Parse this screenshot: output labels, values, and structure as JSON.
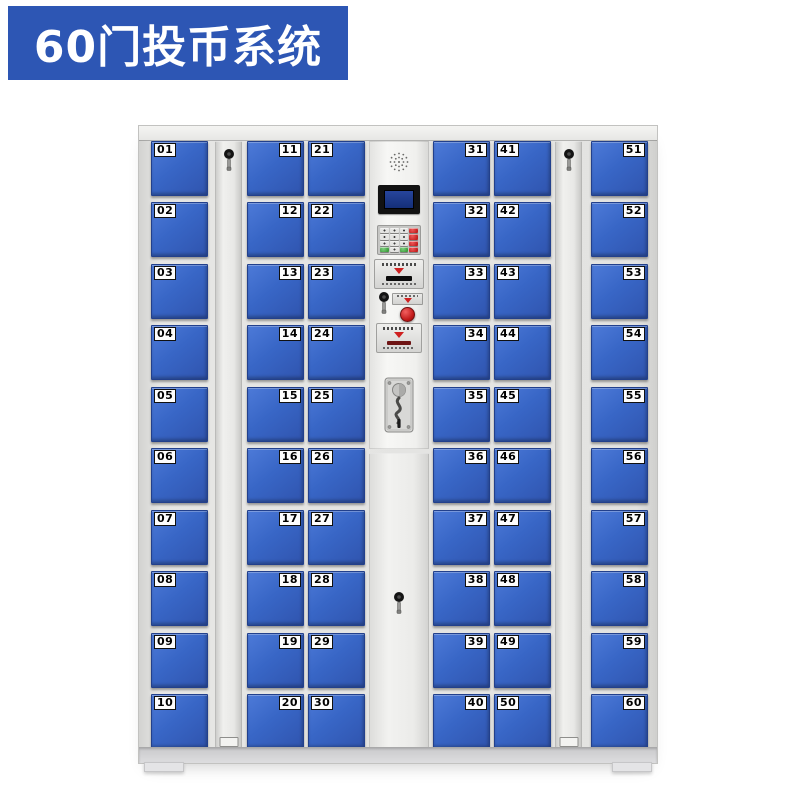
{
  "banner": {
    "title": "60门投币系统",
    "bg_color": "#2d56b4",
    "text_color": "#ffffff"
  },
  "cabinet": {
    "door_count": 60,
    "columns": [
      {
        "type": "doors",
        "label_side": "left",
        "doors": [
          "01",
          "02",
          "03",
          "04",
          "05",
          "06",
          "07",
          "08",
          "09",
          "10"
        ]
      },
      {
        "type": "key-panel"
      },
      {
        "type": "doors",
        "label_side": "right",
        "doors": [
          "11",
          "12",
          "13",
          "14",
          "15",
          "16",
          "17",
          "18",
          "19",
          "20"
        ]
      },
      {
        "type": "doors",
        "label_side": "left",
        "doors": [
          "21",
          "22",
          "23",
          "24",
          "25",
          "26",
          "27",
          "28",
          "29",
          "30"
        ]
      },
      {
        "type": "control-panel"
      },
      {
        "type": "doors",
        "label_side": "right",
        "doors": [
          "31",
          "32",
          "33",
          "34",
          "35",
          "36",
          "37",
          "38",
          "39",
          "40"
        ]
      },
      {
        "type": "doors",
        "label_side": "left",
        "doors": [
          "41",
          "42",
          "43",
          "44",
          "45",
          "46",
          "47",
          "48",
          "49",
          "50"
        ]
      },
      {
        "type": "key-panel"
      },
      {
        "type": "doors",
        "label_side": "right",
        "doors": [
          "51",
          "52",
          "53",
          "54",
          "55",
          "56",
          "57",
          "58",
          "59",
          "60"
        ]
      }
    ],
    "colors": {
      "door_blue": "#3866c6",
      "door_border": "#22408c",
      "frame_gray": "#e3e3e1",
      "lcd_blue": "#1c3e8c",
      "button_red": "#cf2020",
      "key_green": "#3f9f3f"
    },
    "control_panel_icons": [
      "speaker-grill-icon",
      "lcd-display",
      "numeric-keypad",
      "card-reader-slot",
      "key-lock-icon",
      "red-start-button",
      "coin-instruction-plate",
      "coin-acceptor"
    ]
  }
}
